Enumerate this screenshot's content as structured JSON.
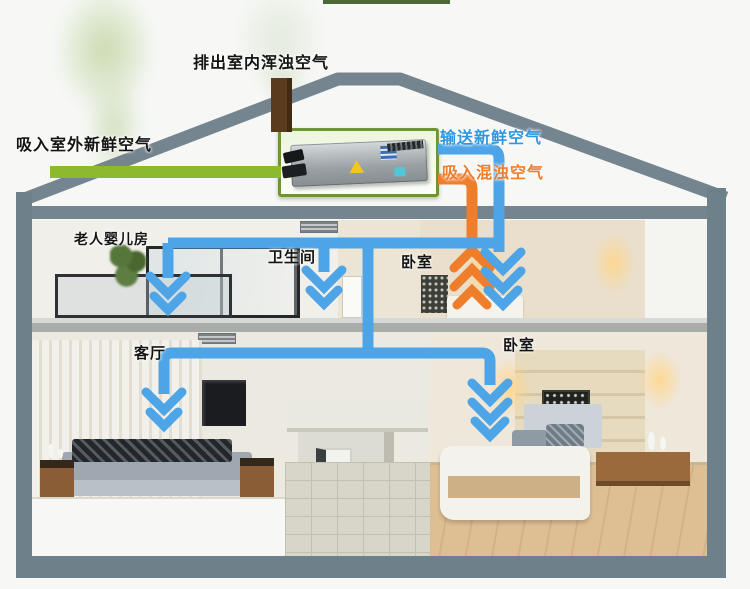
{
  "diagram": {
    "flow_labels": {
      "exhaust_indoor": "排出室内浑浊空气",
      "intake_outdoor": "吸入室外新鲜空气",
      "supply_fresh": "输送新鲜空气",
      "return_stale": "吸入混浊空气"
    },
    "rooms": [
      {
        "id": "elder-baby-room",
        "label": "老人婴儿房"
      },
      {
        "id": "bathroom",
        "label": "卫生间"
      },
      {
        "id": "bedroom-upper",
        "label": "卧室"
      },
      {
        "id": "living-room",
        "label": "客厅"
      },
      {
        "id": "bedroom-lower",
        "label": "卧室"
      }
    ],
    "colors": {
      "fresh_supply_pipe": "#4da5e7",
      "stale_return_pipe": "#ee7d2c",
      "outdoor_intake_pipe": "#8cb92d",
      "exhaust_chimney": "#5a3b1e",
      "house_frame": "#74858f",
      "unit_box_border": "#6e9434"
    }
  }
}
